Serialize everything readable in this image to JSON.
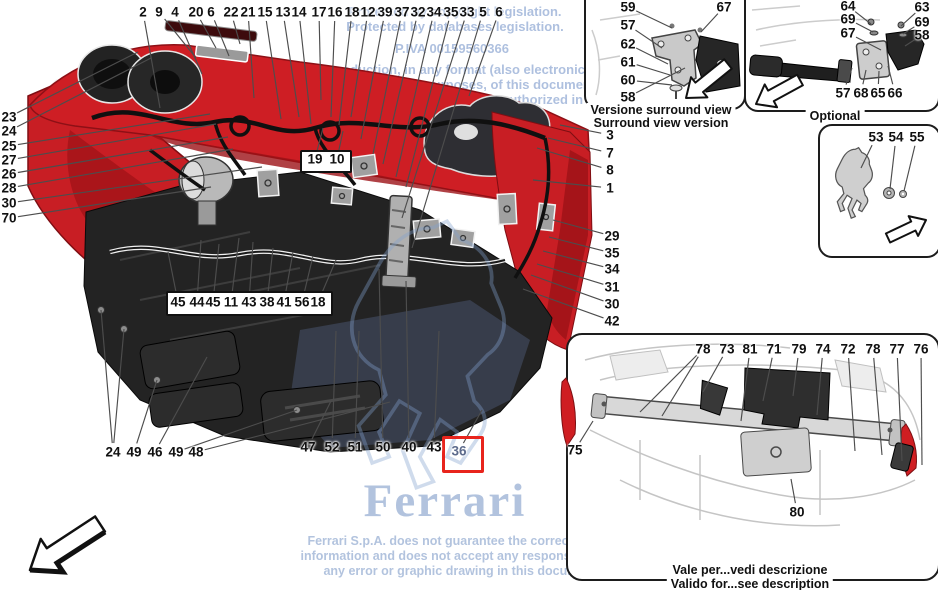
{
  "watermark": {
    "top_lines": [
      "Protected by copyright legislation.",
      "Protected by databases legislation.",
      "P.IVA 00159560366",
      "The reproduction, in any format (also electronic), for",
      "private or commercial purposes, of this document, in",
      "permitted, unless authorized in",
      "S.p.A."
    ],
    "brand": "Ferrari",
    "disclaimer_lines": [
      "Ferrari S.p.A. does not guarantee the correctness of",
      "information and does not accept any responsibility for",
      "any error or graphic drawing in this document."
    ],
    "color": "#7d96c3"
  },
  "main_diagram": {
    "highlighted_part": "36",
    "highlight_color": "#e8241c",
    "callouts": [
      {
        "n": "2",
        "x": 143,
        "y": 12,
        "tx": 160,
        "ty": 108
      },
      {
        "n": "9",
        "x": 159,
        "y": 12,
        "tx": 196,
        "ty": 58
      },
      {
        "n": "4",
        "x": 175,
        "y": 12,
        "tx": 202,
        "ty": 74
      },
      {
        "n": "20",
        "x": 196,
        "y": 12,
        "tx": 216,
        "ty": 48
      },
      {
        "n": "6",
        "x": 211,
        "y": 12,
        "tx": 229,
        "ty": 56
      },
      {
        "n": "22",
        "x": 231,
        "y": 12,
        "tx": 240,
        "ty": 44
      },
      {
        "n": "21",
        "x": 248,
        "y": 12,
        "tx": 254,
        "ty": 98
      },
      {
        "n": "15",
        "x": 265,
        "y": 12,
        "tx": 281,
        "ty": 119
      },
      {
        "n": "13",
        "x": 283,
        "y": 12,
        "tx": 299,
        "ty": 117
      },
      {
        "n": "14",
        "x": 299,
        "y": 12,
        "tx": 311,
        "ty": 124
      },
      {
        "n": "17",
        "x": 319,
        "y": 12,
        "tx": 321,
        "ty": 100
      },
      {
        "n": "16",
        "x": 335,
        "y": 12,
        "tx": 331,
        "ty": 117
      },
      {
        "n": "18",
        "x": 352,
        "y": 12,
        "tx": 339,
        "ty": 125
      },
      {
        "n": "12",
        "x": 368,
        "y": 12,
        "tx": 351,
        "ty": 117
      },
      {
        "n": "39",
        "x": 385,
        "y": 12,
        "tx": 361,
        "ty": 139
      },
      {
        "n": "37",
        "x": 402,
        "y": 12,
        "tx": 373,
        "ty": 154
      },
      {
        "n": "32",
        "x": 418,
        "y": 12,
        "tx": 383,
        "ty": 164
      },
      {
        "n": "34",
        "x": 434,
        "y": 12,
        "tx": 396,
        "ty": 177
      },
      {
        "n": "35",
        "x": 451,
        "y": 12,
        "tx": 406,
        "ty": 187
      },
      {
        "n": "33",
        "x": 467,
        "y": 12,
        "tx": 402,
        "ty": 218
      },
      {
        "n": "5",
        "x": 483,
        "y": 12,
        "tx": 412,
        "ty": 248
      },
      {
        "n": "6",
        "x": 499,
        "y": 12,
        "tx": 469,
        "ty": 96
      },
      {
        "n": "23",
        "x": 9,
        "y": 117,
        "tx": 138,
        "ty": 52
      },
      {
        "n": "24",
        "x": 9,
        "y": 131,
        "tx": 151,
        "ty": 58
      },
      {
        "n": "25",
        "x": 9,
        "y": 146,
        "tx": 210,
        "ty": 114
      },
      {
        "n": "27",
        "x": 9,
        "y": 160,
        "tx": 216,
        "ty": 124
      },
      {
        "n": "26",
        "x": 9,
        "y": 174,
        "tx": 228,
        "ty": 137
      },
      {
        "n": "28",
        "x": 9,
        "y": 188,
        "tx": 233,
        "ty": 149
      },
      {
        "n": "30",
        "x": 9,
        "y": 203,
        "tx": 262,
        "ty": 167
      },
      {
        "n": "70",
        "x": 9,
        "y": 218,
        "tx": 211,
        "ty": 187
      },
      {
        "n": "3",
        "x": 610,
        "y": 135,
        "tx": 560,
        "ty": 125
      },
      {
        "n": "7",
        "x": 610,
        "y": 153,
        "tx": 548,
        "ty": 138
      },
      {
        "n": "8",
        "x": 610,
        "y": 170,
        "tx": 537,
        "ty": 148
      },
      {
        "n": "1",
        "x": 610,
        "y": 188,
        "tx": 533,
        "ty": 180
      },
      {
        "n": "29",
        "x": 612,
        "y": 236,
        "tx": 553,
        "ty": 220
      },
      {
        "n": "35",
        "x": 612,
        "y": 253,
        "tx": 549,
        "ty": 237
      },
      {
        "n": "34",
        "x": 612,
        "y": 269,
        "tx": 543,
        "ty": 251
      },
      {
        "n": "31",
        "x": 612,
        "y": 287,
        "tx": 537,
        "ty": 264
      },
      {
        "n": "30",
        "x": 612,
        "y": 304,
        "tx": 531,
        "ty": 275
      },
      {
        "n": "42",
        "x": 612,
        "y": 321,
        "tx": 523,
        "ty": 289
      },
      {
        "n": "45",
        "x": 178,
        "y": 302,
        "tx": 168,
        "ty": 252
      },
      {
        "n": "44",
        "x": 197,
        "y": 302,
        "tx": 201,
        "ty": 240
      },
      {
        "n": "45",
        "x": 213,
        "y": 302,
        "tx": 219,
        "ty": 244
      },
      {
        "n": "11",
        "x": 231,
        "y": 302,
        "tx": 239,
        "ty": 238
      },
      {
        "n": "43",
        "x": 249,
        "y": 302,
        "tx": 253,
        "ty": 242
      },
      {
        "n": "38",
        "x": 267,
        "y": 302,
        "tx": 273,
        "ty": 248
      },
      {
        "n": "41",
        "x": 284,
        "y": 302,
        "tx": 293,
        "ty": 252
      },
      {
        "n": "56",
        "x": 302,
        "y": 302,
        "tx": 313,
        "ty": 256
      },
      {
        "n": "18",
        "x": 318,
        "y": 302,
        "tx": 336,
        "ty": 260
      },
      {
        "n": "19",
        "x": 315,
        "y": 159,
        "tx": 323,
        "ty": 128
      },
      {
        "n": "10",
        "x": 337,
        "y": 159,
        "tx": 343,
        "ty": 131
      },
      {
        "n": "24",
        "x": 113,
        "y": 452,
        "tx": 101,
        "ty": 310,
        "tx2": 124,
        "ty2": 329
      },
      {
        "n": "49",
        "x": 134,
        "y": 452,
        "tx": 157,
        "ty": 380
      },
      {
        "n": "46",
        "x": 155,
        "y": 452,
        "tx": 207,
        "ty": 357
      },
      {
        "n": "49",
        "x": 176,
        "y": 452,
        "tx": 297,
        "ty": 410
      },
      {
        "n": "48",
        "x": 196,
        "y": 452,
        "tx": 390,
        "ty": 402
      },
      {
        "n": "47",
        "x": 308,
        "y": 447,
        "tx": 331,
        "ty": 401
      },
      {
        "n": "52",
        "x": 332,
        "y": 447,
        "tx": 336,
        "ty": 331
      },
      {
        "n": "51",
        "x": 355,
        "y": 447,
        "tx": 359,
        "ty": 331
      },
      {
        "n": "50",
        "x": 383,
        "y": 447,
        "tx": 379,
        "ty": 269
      },
      {
        "n": "40",
        "x": 409,
        "y": 447,
        "tx": 406,
        "ty": 281
      },
      {
        "n": "43",
        "x": 434,
        "y": 447,
        "tx": 439,
        "ty": 331
      },
      {
        "n": "36",
        "x": 459,
        "y": 451,
        "tx": 482,
        "ty": 410,
        "muted": true
      }
    ]
  },
  "panels": {
    "surround_view": {
      "label_it": "Versione surround view",
      "label_en": "Surround view version",
      "callouts": [
        {
          "n": "59",
          "x": 628,
          "y": 7,
          "tx": 672,
          "ty": 28
        },
        {
          "n": "57",
          "x": 628,
          "y": 25,
          "tx": 662,
          "ty": 48
        },
        {
          "n": "62",
          "x": 628,
          "y": 44,
          "tx": 668,
          "ty": 64
        },
        {
          "n": "61",
          "x": 628,
          "y": 62,
          "tx": 670,
          "ty": 75
        },
        {
          "n": "60",
          "x": 628,
          "y": 80,
          "tx": 672,
          "ty": 85
        },
        {
          "n": "58",
          "x": 628,
          "y": 97,
          "tx": 685,
          "ty": 68
        },
        {
          "n": "67",
          "x": 724,
          "y": 7,
          "tx": 701,
          "ty": 32
        }
      ]
    },
    "optional": {
      "label": "Optional",
      "callouts": [
        {
          "n": "64",
          "x": 848,
          "y": 6,
          "tx": 871,
          "ty": 24
        },
        {
          "n": "69",
          "x": 848,
          "y": 19,
          "tx": 873,
          "ty": 32
        },
        {
          "n": "67",
          "x": 848,
          "y": 33,
          "tx": 881,
          "ty": 50
        },
        {
          "n": "63",
          "x": 922,
          "y": 7,
          "tx": 901,
          "ty": 26
        },
        {
          "n": "69",
          "x": 922,
          "y": 22,
          "tx": 903,
          "ty": 34
        },
        {
          "n": "58",
          "x": 922,
          "y": 35,
          "tx": 905,
          "ty": 46
        },
        {
          "n": "57",
          "x": 843,
          "y": 93,
          "tx": 852,
          "ty": 68
        },
        {
          "n": "68",
          "x": 861,
          "y": 93,
          "tx": 866,
          "ty": 70
        },
        {
          "n": "65",
          "x": 878,
          "y": 93,
          "tx": 879,
          "ty": 71
        },
        {
          "n": "66",
          "x": 895,
          "y": 93,
          "tx": 888,
          "ty": 66
        }
      ]
    },
    "horse": {
      "callouts": [
        {
          "n": "53",
          "x": 876,
          "y": 137,
          "tx": 861,
          "ty": 168
        },
        {
          "n": "54",
          "x": 896,
          "y": 137,
          "tx": 890,
          "ty": 189
        },
        {
          "n": "55",
          "x": 917,
          "y": 137,
          "tx": 904,
          "ty": 191
        }
      ]
    },
    "validity": {
      "label_it": "Vale per...vedi descrizione",
      "label_en": "Valido for...see description",
      "callouts": [
        {
          "n": "78",
          "x": 703,
          "y": 349,
          "tx": 640,
          "ty": 412,
          "tx2": 662,
          "ty2": 416
        },
        {
          "n": "73",
          "x": 727,
          "y": 349,
          "tx": 703,
          "ty": 392
        },
        {
          "n": "81",
          "x": 750,
          "y": 349,
          "tx": 741,
          "ty": 421
        },
        {
          "n": "71",
          "x": 774,
          "y": 349,
          "tx": 763,
          "ty": 401
        },
        {
          "n": "79",
          "x": 799,
          "y": 349,
          "tx": 793,
          "ty": 396
        },
        {
          "n": "74",
          "x": 823,
          "y": 349,
          "tx": 817,
          "ty": 415
        },
        {
          "n": "72",
          "x": 848,
          "y": 349,
          "tx": 855,
          "ty": 451
        },
        {
          "n": "78",
          "x": 873,
          "y": 349,
          "tx": 882,
          "ty": 455
        },
        {
          "n": "77",
          "x": 897,
          "y": 349,
          "tx": 902,
          "ty": 461
        },
        {
          "n": "76",
          "x": 921,
          "y": 349,
          "tx": 922,
          "ty": 465
        },
        {
          "n": "75",
          "x": 575,
          "y": 450,
          "tx": 593,
          "ty": 421
        },
        {
          "n": "80",
          "x": 797,
          "y": 512,
          "tx": 791,
          "ty": 479
        }
      ]
    }
  }
}
